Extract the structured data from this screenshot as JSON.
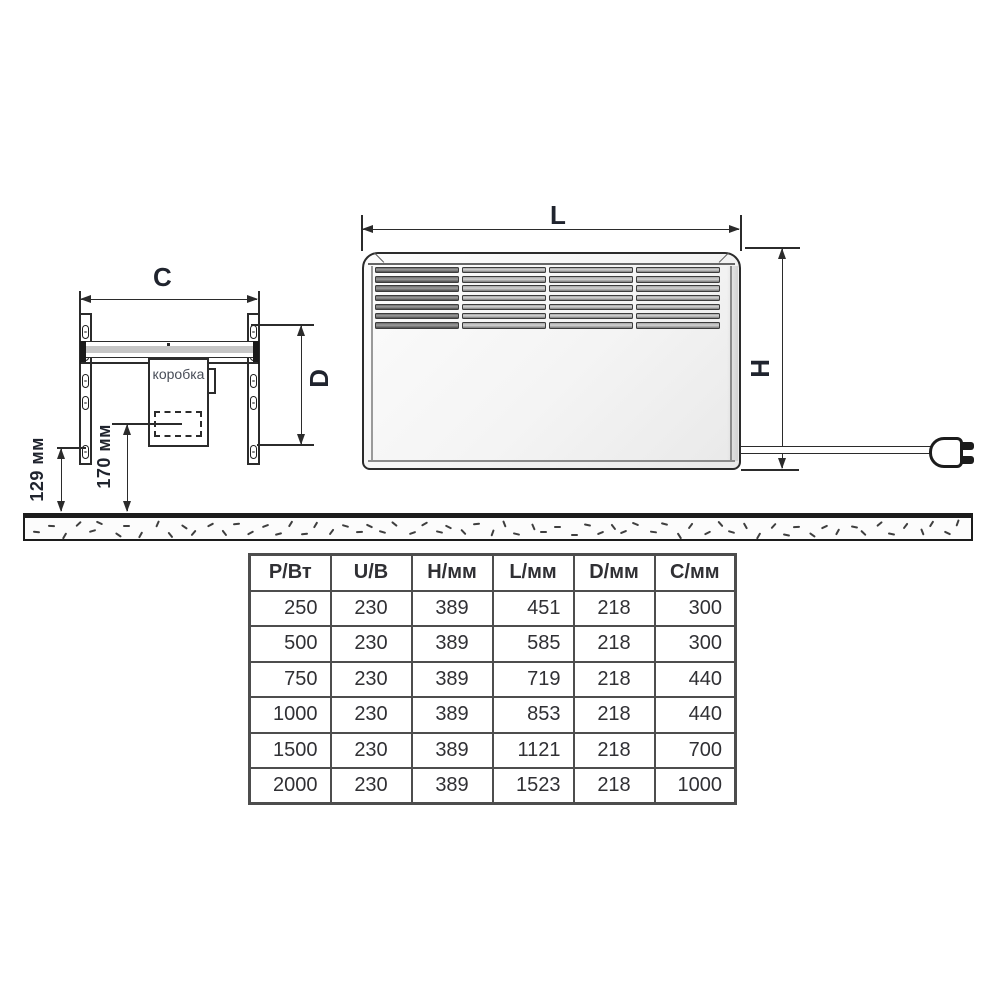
{
  "drawing": {
    "bracket": {
      "width_dim_label": "C",
      "depth_dim_label": "D",
      "junction_box_label": "коробка",
      "floor_offset_dim": "129 мм",
      "box_offset_dim": "170 мм"
    },
    "heater": {
      "length_dim_label": "L",
      "height_dim_label": "H"
    }
  },
  "table": {
    "headers": [
      "Р/Вт",
      "U/В",
      "Н/мм",
      "L/мм",
      "D/мм",
      "С/мм"
    ],
    "rows": [
      [
        "250",
        "230",
        "389",
        "451",
        "218",
        "300"
      ],
      [
        "500",
        "230",
        "389",
        "585",
        "218",
        "300"
      ],
      [
        "750",
        "230",
        "389",
        "719",
        "218",
        "440"
      ],
      [
        "1000",
        "230",
        "389",
        "853",
        "218",
        "440"
      ],
      [
        "1500",
        "230",
        "389",
        "1121",
        "218",
        "700"
      ],
      [
        "2000",
        "230",
        "389",
        "1523",
        "218",
        "1000"
      ]
    ]
  },
  "colors": {
    "line": "#2b2b2b",
    "table_border": "#4d4d4d",
    "table_text": "#303034",
    "label_text": "#20242e"
  }
}
